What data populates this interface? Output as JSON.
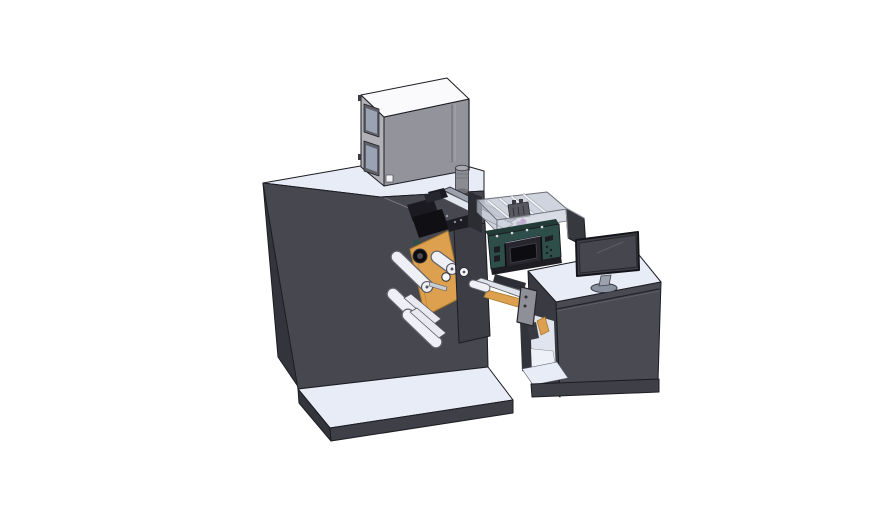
{
  "meta": {
    "kind": "3d-cad-isometric-render",
    "description": "SolidWorks-style isometric rendering of a compact label printing / converting machine line: a large dark cabinet with a gray feeder box on top, a web-path bay with orange mount plates and white guide rollers, a teal control unit with display inside a transparent guard enclosure, a short conveyor bridge with a sensor bracket, and an operator desk with a monitor.",
    "background": "#ffffff",
    "visible_text": "none"
  },
  "palette": {
    "bg": "#ffffff",
    "outline": "#1c1c22",
    "machineFront": "#47474f",
    "machineLeft": "#34343c",
    "topLight": "#e8ecf6",
    "platformSkirt": "#3f3f48",
    "boxFront": "#93939b",
    "boxLeft": "#b1b1b7",
    "boxTop": "#fafafc",
    "windowFrame": "#5f5f67",
    "windowGlass": "#9aa3b4",
    "cylGray": "#8b8b93",
    "cylTop": "#a8a8b0",
    "orange": "#dda04f",
    "orangeDark": "#a97a2e",
    "teal": "#2e4f49",
    "tealDark": "#223b36",
    "bezelDark": "#26262c",
    "screenBlack": "#0d0d11",
    "rollerWhite": "#eef0f5",
    "rollerEdge": "#63636b",
    "railLight": "#e2e6ee",
    "railDark": "#9aa0ac",
    "glass": "#c8cdd8",
    "glassWall": "#b9bec9",
    "blackPart": "#101014",
    "blackPart2": "#1a1a20",
    "deskFront": "#4a4a53",
    "deskLeft": "#3a3a43",
    "deskInterior": "#dfe4ee",
    "deskFloor": "#eef1f8",
    "monitorBezel": "#3f3f47",
    "monitorScreen": "#46464e",
    "standGray": "#9aa2ae",
    "standBase": "#8a92a0",
    "bracketGray": "#8f8f97",
    "armDark": "#2e2e36",
    "shadowDark": "#1d1d23",
    "magenta": "#c158c0",
    "violet": "#9a6ab8",
    "screwLight": "#d9dde6"
  },
  "parts": [
    {
      "id": "feeder-top-cabinet",
      "label": "gray feeder cabinet on machine roof",
      "color": "#93939b"
    },
    {
      "id": "cabinet-windows",
      "label": "two inspection windows on cabinet left face",
      "color": "#9aa3b4"
    },
    {
      "id": "exhaust-cylinder",
      "label": "small exhaust cylinder beside cabinet",
      "color": "#8b8b93"
    },
    {
      "id": "main-machine-body",
      "label": "large dark machine cabinet",
      "color": "#47474f"
    },
    {
      "id": "machine-base-plate",
      "label": "light base platform under machine",
      "color": "#e8ecf6"
    },
    {
      "id": "print-head-cluster",
      "label": "black print/die head mechanism",
      "color": "#101014"
    },
    {
      "id": "orange-mount-plate",
      "label": "orange roller mount plate",
      "color": "#dda04f"
    },
    {
      "id": "guide-rollers",
      "label": "white web guide rollers",
      "count": 6,
      "color": "#eef0f5"
    },
    {
      "id": "bay-cover-plate",
      "label": "dark bay cover plate with hole",
      "color": "#3d3d46"
    },
    {
      "id": "guard-enclosure",
      "label": "transparent guard enclosure with slide rails",
      "color": "#c8cdd8"
    },
    {
      "id": "teal-control-unit",
      "label": "teal control unit",
      "color": "#2e4f49"
    },
    {
      "id": "control-display",
      "label": "black display on control unit",
      "color": "#0d0d11"
    },
    {
      "id": "conveyor-bridge",
      "label": "conveyor bridge with orange belt",
      "color": "#dda04f"
    },
    {
      "id": "sensor-bracket",
      "label": "gray hanging sensor bracket",
      "color": "#8f8f97"
    },
    {
      "id": "operator-desk",
      "label": "operator desk cabinet with open side shelf",
      "color": "#4a4a53"
    },
    {
      "id": "desk-monitor",
      "label": "desktop monitor on round stand",
      "color": "#3f3f47"
    },
    {
      "id": "side-screen-panel",
      "label": "second flat panel seen edge-on",
      "color": "#38383f"
    }
  ]
}
